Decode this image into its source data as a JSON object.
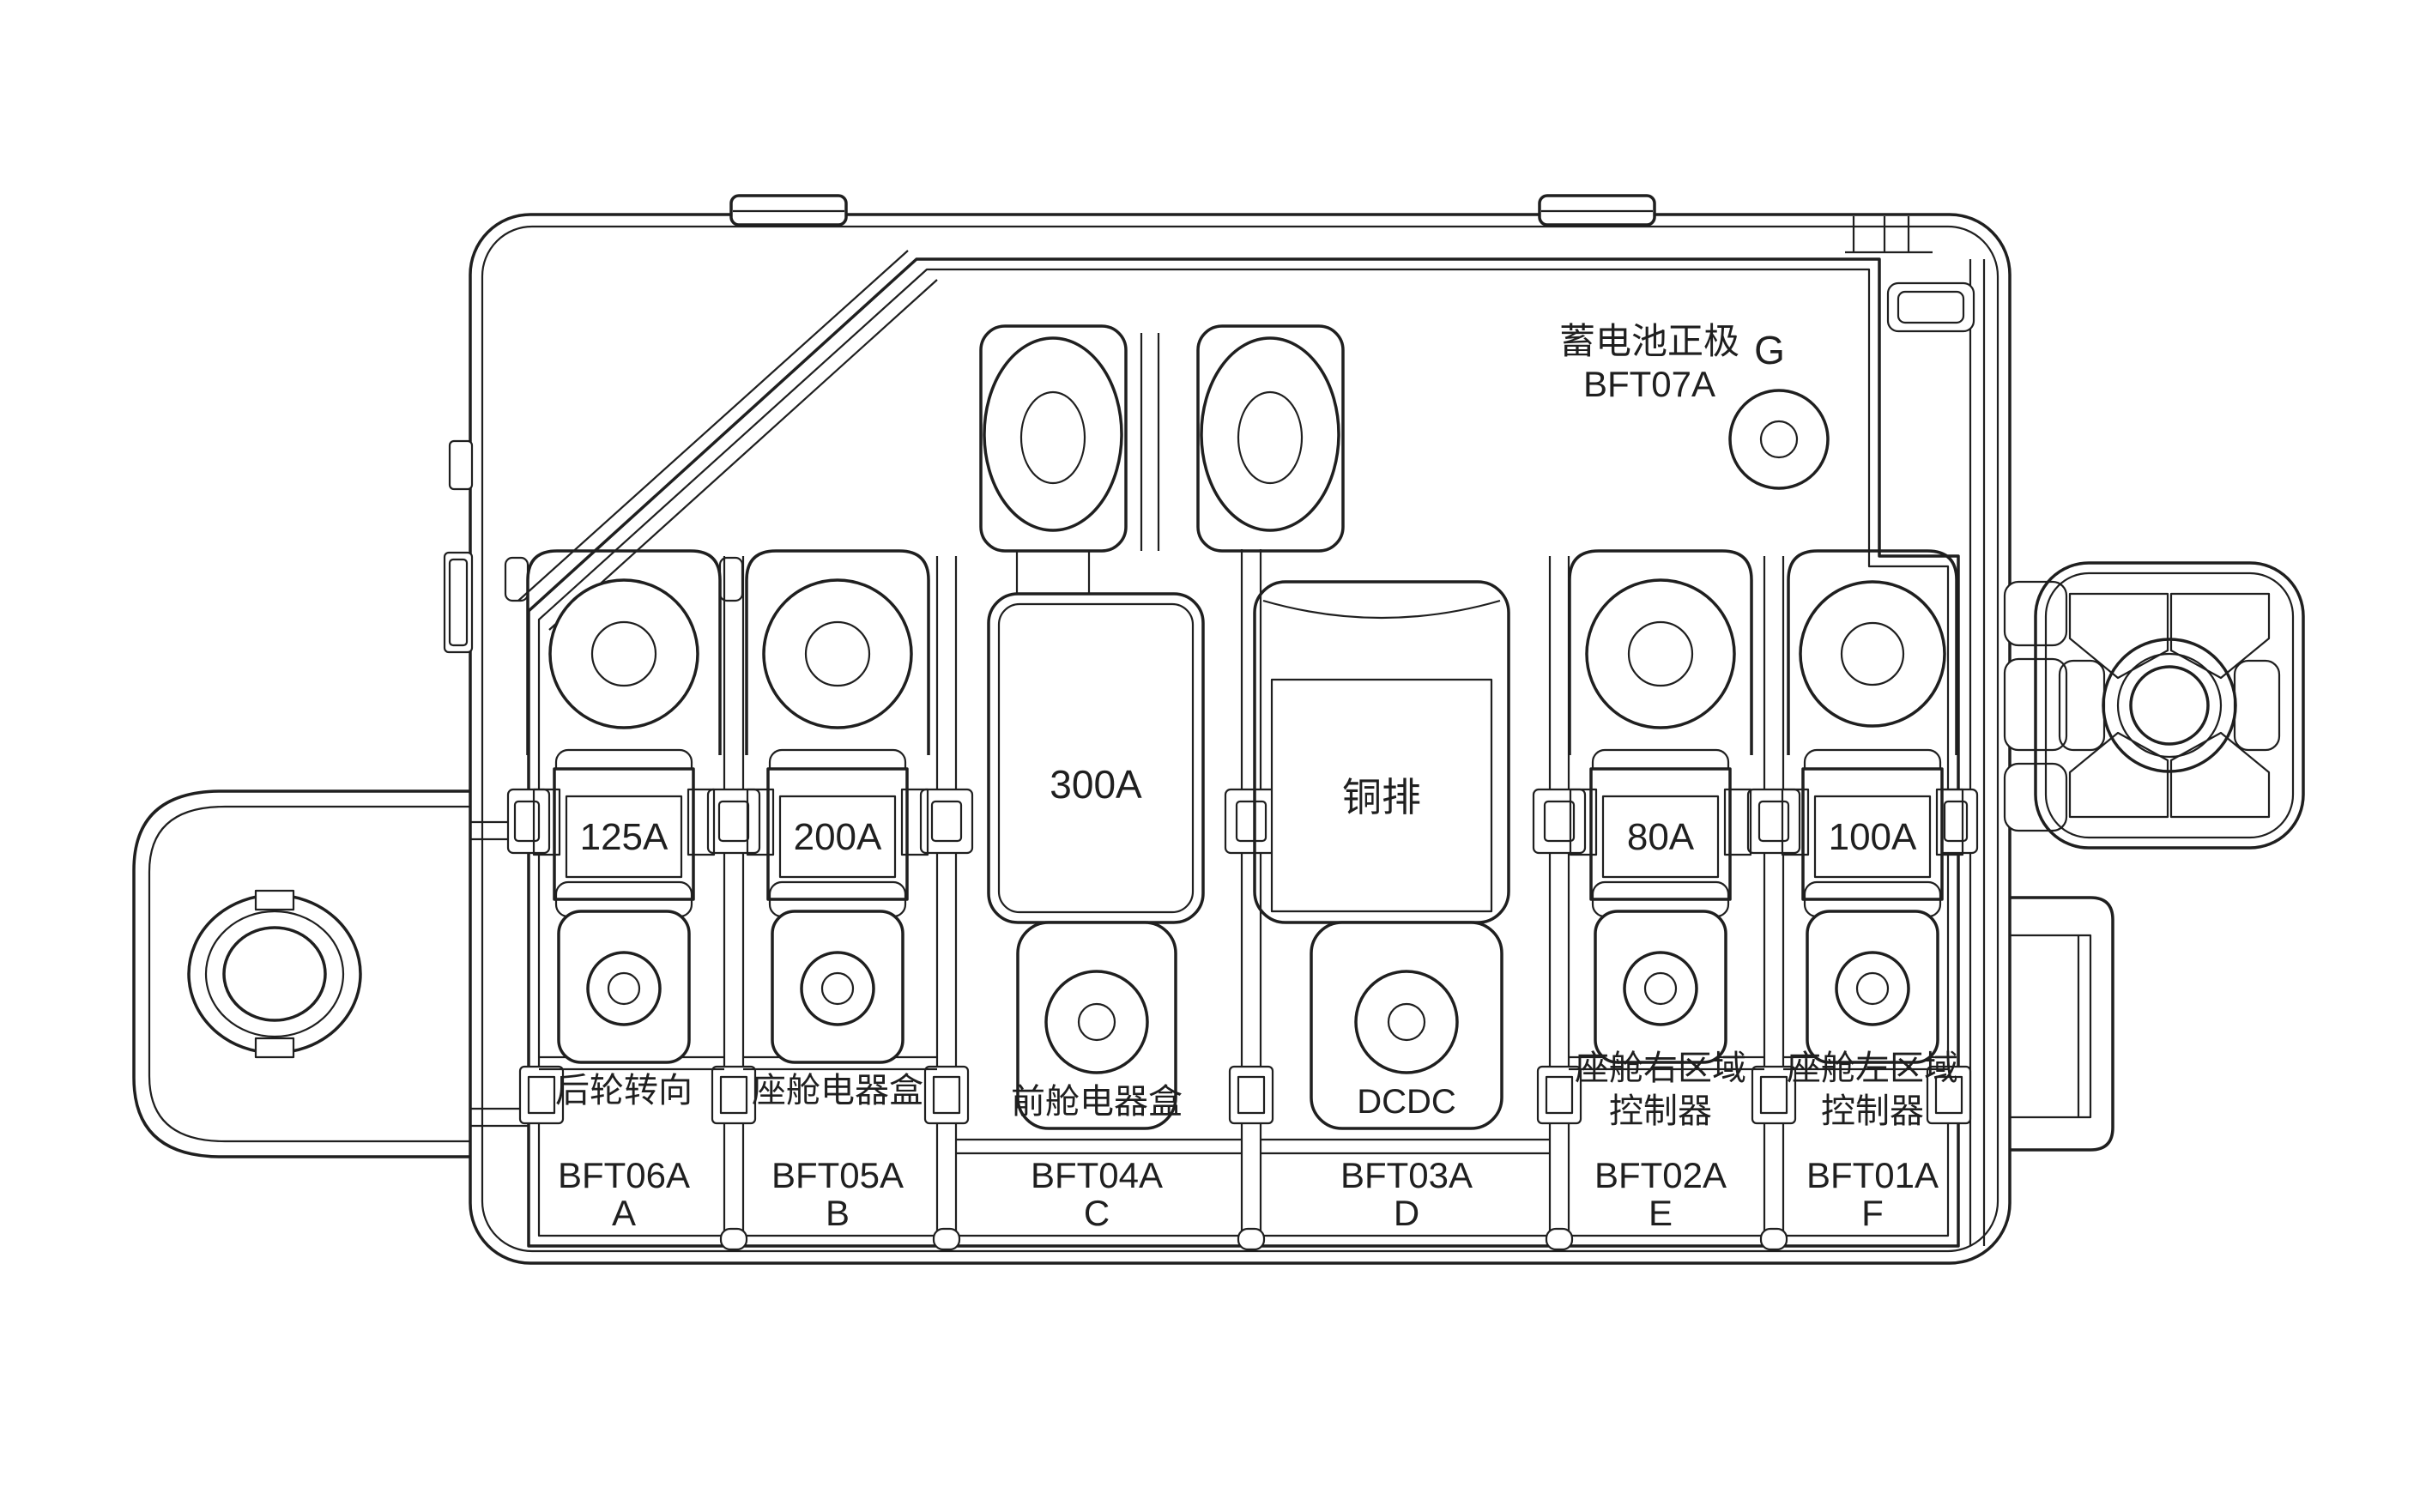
{
  "title": {
    "battery_positive": "蓄电池正极",
    "battery_positive_code": "BFT07A",
    "terminal_g": "G"
  },
  "fuses": [
    {
      "slot": "A",
      "code": "BFT06A",
      "rating": "125A",
      "circuit": "后轮转向"
    },
    {
      "slot": "B",
      "code": "BFT05A",
      "rating": "200A",
      "circuit": "座舱电器盒"
    },
    {
      "slot": "C",
      "code": "BFT04A",
      "rating": "300A",
      "circuit": "前舱电器盒"
    },
    {
      "slot": "D",
      "code": "BFT03A",
      "rating": "铜排",
      "circuit": "DCDC"
    },
    {
      "slot": "E",
      "code": "BFT02A",
      "rating": "80A",
      "circuit_lines": [
        "座舱右区域",
        "控制器"
      ]
    },
    {
      "slot": "F",
      "code": "BFT01A",
      "rating": "100A",
      "circuit_lines": [
        "座舱左区域",
        "控制器"
      ]
    }
  ],
  "colors": {
    "line": "#1f1f1f",
    "background": "#ffffff"
  }
}
